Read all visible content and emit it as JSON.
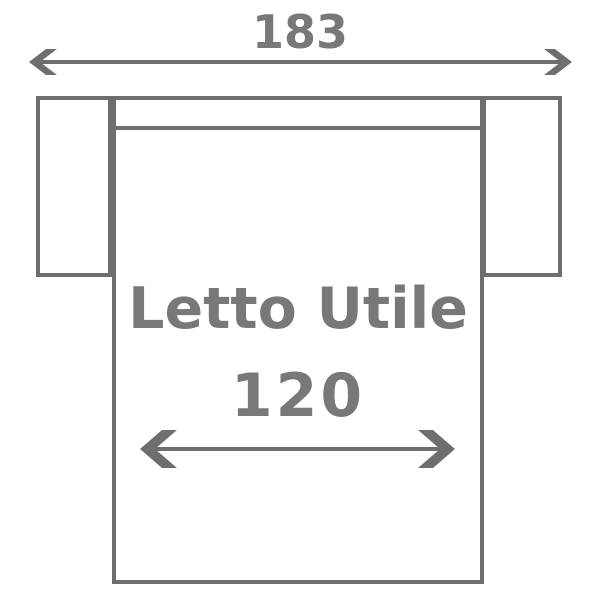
{
  "diagram": {
    "labels": {
      "total_width": "183",
      "bed_label": "Letto Utile",
      "bed_width": "120"
    },
    "colors": {
      "outline": "#6e6e6e",
      "text": "#787878",
      "background": "#ffffff"
    }
  }
}
